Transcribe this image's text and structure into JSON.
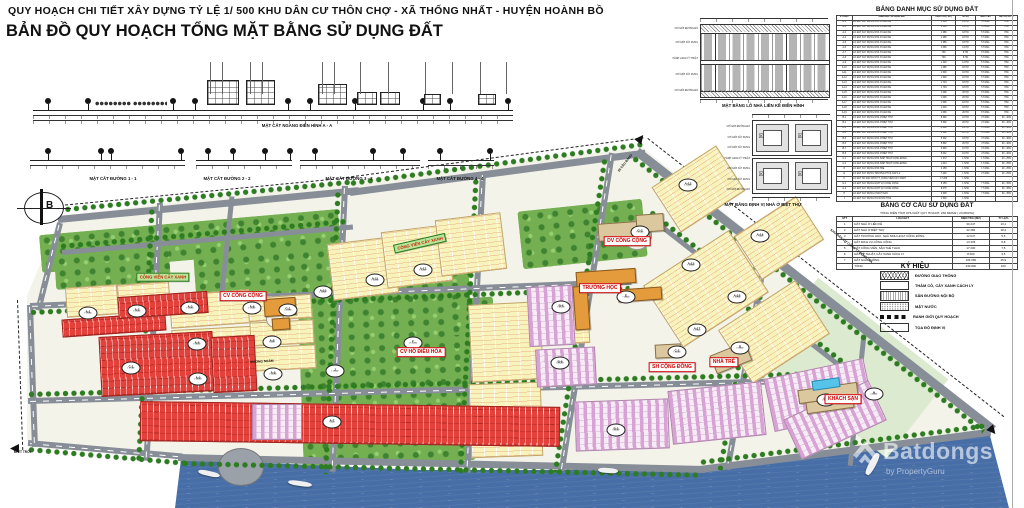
{
  "header": {
    "line1": "QUY HOẠCH CHI TIẾT XÂY DỰNG TỶ LỆ 1/ 500 KHU DÂN CƯ THÔN CHỢ - XÃ THỐNG NHẤT - HUYỆN HOÀNH BỒ",
    "line2": "BẢN ĐỒ QUY HOẠCH TỔNG MẶT BẰNG SỬ DỤNG ĐẤT"
  },
  "sections": {
    "aa": "MẶT CẮT NGANG ĐIỂN HÌNH A - A",
    "s1": "MẶT CẮT ĐƯỜNG 1 - 1",
    "s2": "MẶT CẮT ĐƯỜNG 2 - 2",
    "s3": "MẶT CẮT ĐƯỜNG 3 - 3",
    "s4": "MẶT CẮT ĐƯỜNG 4 - 4"
  },
  "diagrams": {
    "d1_caption": "MẶT BẰNG LÔ NHÀ LIỀN KỀ ĐIỂN HÌNH",
    "d2_caption": "MẶT BẰNG ĐỊNH VỊ NHÀ Ở BIỆT THỰ",
    "d1_side_labels": [
      "CHỈ GIỚI ĐƯỜNG ĐỎ",
      "CHỈ GIỚI XÂY DỰNG",
      "HÀNH LANG KỸ THUẬT",
      "CHỈ GIỚI XÂY DỰNG",
      "CHỈ GIỚI ĐƯỜNG ĐỎ"
    ],
    "d2_side_labels": [
      "CHỈ GIỚI ĐƯỜNG ĐỎ",
      "CHỈ GIỚI XÂY DỰNG",
      "CHỈ GIỚI XÂY DỰNG",
      "HÀNH LANG KỸ THUẬT",
      "CHỈ GIỚI XÂY DỰNG",
      "CHỈ GIỚI XÂY DỰNG",
      "CHỈ GIỚI ĐƯỜNG ĐỎ"
    ]
  },
  "land_use_table": {
    "title": "BẢNG DANH MỤC SỬ DỤNG ĐẤT",
    "headers": [
      "KÝ HIỆU",
      "DANH MỤC SỬ DỤNG ĐẤT",
      "DIỆN TÍCH ( M2 )",
      "SỐ HỘ",
      "TẦNG CAO",
      "MẬT ĐỘ XD %"
    ],
    "rows": [
      [
        "A-1",
        "LÔ ĐẤT XÂY DỰNG NHÀ Ở LIỀN KỀ",
        "1 096",
        "14 HỘ",
        "5 TẦNG",
        "70%"
      ],
      [
        "A-2",
        "LÔ ĐẤT XÂY DỰNG NHÀ Ở LIỀN KỀ",
        "1 096",
        "14 HỘ",
        "5 TẦNG",
        "70%"
      ],
      [
        "A-3",
        "LÔ ĐẤT XÂY DỰNG NHÀ Ở LIỀN KỀ",
        "1 386",
        "18 HỘ",
        "5 TẦNG",
        "70%"
      ],
      [
        "A-4",
        "LÔ ĐẤT XÂY DỰNG NHÀ Ở LIỀN KỀ",
        "1 386",
        "18 HỘ",
        "5 TẦNG",
        "70%"
      ],
      [
        "A-5",
        "LÔ ĐẤT XÂY DỰNG NHÀ Ở LIỀN KỀ",
        "1 386",
        "18 HỘ",
        "5 TẦNG",
        "70%"
      ],
      [
        "A-6",
        "LÔ ĐẤT XÂY DỰNG NHÀ Ở LIỀN KỀ",
        "1 096",
        "14 HỘ",
        "5 TẦNG",
        "70%"
      ],
      [
        "A-7",
        "LÔ ĐẤT XÂY DỰNG NHÀ Ở LIỀN KỀ",
        "790",
        "8 HỘ",
        "5 TẦNG",
        "70%"
      ],
      [
        "A-8",
        "LÔ ĐẤT XÂY DỰNG NHÀ Ở LIỀN KỀ",
        "790",
        "8 HỘ",
        "5 TẦNG",
        "70%"
      ],
      [
        "A-9",
        "LÔ ĐẤT XÂY DỰNG NHÀ Ở LIỀN KỀ",
        "1 400",
        "14 HỘ",
        "5 TẦNG",
        "70%"
      ],
      [
        "A-10",
        "LÔ ĐẤT XÂY DỰNG NHÀ Ở LIỀN KỀ",
        "1 386",
        "18 HỘ",
        "5 TẦNG",
        "70%"
      ],
      [
        "A-11",
        "LÔ ĐẤT XÂY DỰNG NHÀ Ở LIỀN KỀ",
        "1 600",
        "16 HỘ",
        "5 TẦNG",
        "70%"
      ],
      [
        "A-12",
        "LÔ ĐẤT XÂY DỰNG NHÀ Ở LIỀN KỀ",
        "1 600",
        "16 HỘ",
        "5 TẦNG",
        "70%"
      ],
      [
        "A-13",
        "LÔ ĐẤT XÂY DỰNG NHÀ Ở LIỀN KỀ",
        "1 704",
        "18 HỘ",
        "5 TẦNG",
        "70%"
      ],
      [
        "A-14",
        "LÔ ĐẤT XÂY DỰNG NHÀ Ở LIỀN KỀ",
        "1 704",
        "18 HỘ",
        "5 TẦNG",
        "70%"
      ],
      [
        "A-15",
        "LÔ ĐẤT XÂY DỰNG NHÀ Ở LIỀN KỀ",
        "1 096",
        "20 HỘ",
        "5 TẦNG",
        "70%"
      ],
      [
        "A-16",
        "LÔ ĐẤT XÂY DỰNG NHÀ Ở LIỀN KỀ",
        "1 096",
        "20 HỘ",
        "5 TẦNG",
        "70%"
      ],
      [
        "A-17",
        "LÔ ĐẤT XÂY DỰNG NHÀ Ở LIỀN KỀ",
        "1 096",
        "18 HỘ",
        "5 TẦNG",
        "70%"
      ],
      [
        "A-18",
        "LÔ ĐẤT XÂY DỰNG NHÀ Ở LIỀN KỀ",
        "1 003",
        "18 HỘ",
        "5 TẦNG",
        "70%"
      ],
      [
        "A-19",
        "LÔ ĐẤT XÂY DỰNG NHÀ Ở LIỀN KỀ",
        "1 096",
        "20 HỘ",
        "5 TẦNG",
        "70%"
      ],
      [
        "B-1",
        "LÔ ĐẤT XÂY DỰNG NHÀ Ở BIỆT THỰ",
        "5 692",
        "16 HỘ",
        "3 TẦNG",
        "30 - 40%"
      ],
      [
        "B-2",
        "LÔ ĐẤT XÂY DỰNG NHÀ Ở BIỆT THỰ",
        "5 692",
        "20 HỘ",
        "3 TẦNG",
        "30 - 40%"
      ],
      [
        "B-3",
        "LÔ ĐẤT XÂY DỰNG NHÀ Ở BIỆT THỰ",
        "6 288",
        "24 HỘ",
        "3 TẦNG",
        "30 - 40%"
      ],
      [
        "B-4",
        "LÔ ĐẤT XÂY DỰNG NHÀ Ở BIỆT THỰ",
        "5 692",
        "20 HỘ",
        "3 TẦNG",
        "30 - 40%"
      ],
      [
        "B-5",
        "LÔ ĐẤT XÂY DỰNG NHÀ Ở BIỆT THỰ",
        "5 302",
        "18 HỘ",
        "3 TẦNG",
        "30 - 40%"
      ],
      [
        "B-6",
        "LÔ ĐẤT XÂY DỰNG NHÀ Ở BIỆT THỰ",
        "5 892",
        "20 HỘ",
        "3 TẦNG",
        "30 - 40%"
      ],
      [
        "B-7",
        "LÔ ĐẤT XÂY DỰNG NHÀ Ở BIỆT THỰ",
        "3 690",
        "10 HỘ",
        "3 TẦNG",
        "30 - 40%"
      ],
      [
        "B-8",
        "LÔ ĐẤT XÂY DỰNG NHÀ Ở BIỆT THỰ",
        "5 042",
        "16 HỘ",
        "3 TẦNG",
        "30 - 40%"
      ],
      [
        "C-1",
        "LÔ ĐẤT XÂY DỰNG NHÀ SINH HOẠT CỘNG ĐỒNG",
        "1 372",
        "1 NHÀ",
        "1 TẦNG",
        "20 - 25%"
      ],
      [
        "C-2",
        "LÔ ĐẤT XÂY DỰNG NHÀ SINH HOẠT CỘNG ĐỒNG",
        "1 044",
        "1 NHÀ",
        "1 TẦNG",
        "20 - 25%"
      ],
      [
        "D",
        "LÔ ĐẤT XÂY DỰNG NHÀ TRẺ",
        "2 158",
        "1 NHÀ",
        "1 TẦNG",
        "20 - 25%"
      ],
      [
        "E",
        "LÔ ĐẤT XÂY DỰNG TRƯỜNG PTCS CẤP 1,2",
        "7 200",
        "1 NHÀ",
        "2 TẦNG",
        "20 - 25%"
      ],
      [
        "F",
        "LÔ ĐẤT XD SÂN CHƠI TT, CÔNG VIÊN CÂY XANH",
        "17 200",
        "1 NHÀ",
        "",
        ""
      ],
      [
        "G-1",
        "LÔ ĐẤT XÂY DỰNG DỊCH VỤ CÔNG CỘNG",
        "5 158",
        "1 NHÀ",
        "7 TẦNG",
        "30 - 35%"
      ],
      [
        "G-2",
        "LÔ ĐẤT XÂY DỰNG DỊCH VỤ CÔNG CỘNG",
        "8 075",
        "1 NHÀ",
        "7 TẦNG",
        "30 - 35%"
      ],
      [
        "H",
        "LÔ ĐẤT XÂY DỰNG KHÁCH SẠN",
        "4 608",
        "1 NHÀ",
        "7 TẦNG",
        "30 - 35%"
      ],
      [
        "J",
        "LÔ ĐẤT XÂY DỰNG HỒ NƯỚC THẢI",
        "1 500",
        "1 NHÀ",
        "",
        ""
      ]
    ]
  },
  "structure_table": {
    "title": "BẢNG CƠ CẤU SỬ DỤNG ĐẤT",
    "subtitle": "TỔNG DIỆN TÍCH KHU ĐẤT QUY HOẠCH: 230 840M2 ( 23,084HA)",
    "headers": [
      "STT",
      "LOẠI ĐẤT",
      "DIỆN TÍCH (M2)",
      "TỶ LỆ%"
    ],
    "rows": [
      [
        "1",
        "ĐẤT NHÀ Ở LIỀN KỀ",
        "30 247",
        "13,1"
      ],
      [
        "2",
        "ĐẤT NHÀ Ở BIỆT THỰ",
        "42 282",
        "18,4"
      ],
      [
        "3",
        "ĐẤT TRƯỜNG HỌC, NHÀ SINH HOẠT CỘNG ĐỒNG",
        "12 647",
        "5,5"
      ],
      [
        "4",
        "ĐẤT DỊCH VỤ CÔNG CỘNG",
        "13 333",
        "5,8"
      ],
      [
        "5",
        "ĐẤT CÔNG VIÊN, SÂN THỂ THAO",
        "17 200",
        "7,5"
      ],
      [
        "6",
        "ĐẤT KỸ THUẬT, CÂY XANH CÁCH LY",
        "8 000",
        "3,5"
      ],
      [
        "7",
        "ĐẤT GIAO THÔNG",
        "106 065",
        "45,9"
      ],
      [
        "",
        "TỔNG",
        "230 840",
        "100"
      ]
    ]
  },
  "legend": {
    "title": "KÝ HIỆU",
    "items": [
      "ĐƯỜNG GIAO THÔNG",
      "THẢM CỎ, CÂY XANH CÁCH LY",
      "SÂN ĐƯỜNG NỘI BỘ",
      "MẶT NƯỚC",
      "RANH GIỚI QUY HOẠCH",
      "TỌA ĐỘ ĐỊNH VỊ"
    ]
  },
  "map": {
    "compass": "B",
    "area_badges": [
      {
        "label": "A-1",
        "sub": "1 096M2",
        "x": 88,
        "y": 313
      },
      {
        "label": "A-2",
        "sub": "1 096M2",
        "x": 137,
        "y": 311
      },
      {
        "label": "A-3",
        "sub": "1 386M2",
        "x": 190,
        "y": 308
      },
      {
        "label": "A-4",
        "sub": "1 386M2",
        "x": 197,
        "y": 344
      },
      {
        "label": "A-5",
        "sub": "1 386M2",
        "x": 198,
        "y": 379
      },
      {
        "label": "A-6",
        "sub": "1 096M2",
        "x": 252,
        "y": 308
      },
      {
        "label": "A-7",
        "sub": "790M2",
        "x": 332,
        "y": 422
      },
      {
        "label": "A-8",
        "sub": "790M2",
        "x": 272,
        "y": 342
      },
      {
        "label": "A-9",
        "sub": "1 400M2",
        "x": 273,
        "y": 374
      },
      {
        "label": "A-10",
        "sub": "1 386M2",
        "x": 323,
        "y": 292
      },
      {
        "label": "A-11",
        "sub": "1 600M2",
        "x": 375,
        "y": 280
      },
      {
        "label": "A-12",
        "sub": "1 600M2",
        "x": 423,
        "y": 270
      },
      {
        "label": "A-13",
        "sub": "1 704M2",
        "x": 688,
        "y": 185
      },
      {
        "label": "A-14",
        "sub": "1 704M2",
        "x": 760,
        "y": 236
      },
      {
        "label": "A-15",
        "sub": "1 096M2",
        "x": 691,
        "y": 265
      },
      {
        "label": "A-16",
        "sub": "1 096M2",
        "x": 737,
        "y": 297
      },
      {
        "label": "A-17",
        "sub": "1 096M2",
        "x": 697,
        "y": 330
      },
      {
        "label": "B-4",
        "sub": "5 692M2",
        "x": 561,
        "y": 307
      },
      {
        "label": "B-5",
        "sub": "5 302M2",
        "x": 616,
        "y": 430
      },
      {
        "label": "B-6",
        "sub": "5 892M2",
        "x": 560,
        "y": 363
      },
      {
        "label": "B-8",
        "sub": "5 042M2",
        "x": 826,
        "y": 400
      },
      {
        "label": "C-1",
        "sub": "1 372M2",
        "x": 131,
        "y": 368
      },
      {
        "label": "C-2",
        "sub": "1 044M2",
        "x": 677,
        "y": 352
      },
      {
        "label": "D",
        "sub": "2 158M2",
        "x": 740,
        "y": 348
      },
      {
        "label": "E",
        "sub": "7 200M2",
        "x": 626,
        "y": 297
      },
      {
        "label": "F",
        "sub": "17 200M2",
        "x": 413,
        "y": 343
      },
      {
        "label": "G-1",
        "sub": "5 158M2",
        "x": 288,
        "y": 310
      },
      {
        "label": "G-2",
        "sub": "8 075M2",
        "x": 640,
        "y": 232
      },
      {
        "label": "H",
        "sub": "4 608M2",
        "x": 874,
        "y": 394
      },
      {
        "label": "J",
        "sub": "1 500M2",
        "x": 335,
        "y": 371
      }
    ],
    "site_labels": [
      {
        "text": "CV CÔNG CỘNG",
        "x": 243,
        "y": 296,
        "style": "red",
        "rot": 0
      },
      {
        "text": "DV CÔNG CỘNG",
        "x": 627,
        "y": 241,
        "style": "red",
        "rot": 0
      },
      {
        "text": "TRƯỜNG HỌC",
        "x": 600,
        "y": 288,
        "style": "red",
        "rot": 0
      },
      {
        "text": "CV HỒ ĐIỀU HÒA",
        "x": 421,
        "y": 352,
        "style": "red",
        "rot": 0
      },
      {
        "text": "SH CỘNG ĐỒNG",
        "x": 672,
        "y": 367,
        "style": "red",
        "rot": 0
      },
      {
        "text": "NHÀ TRẺ",
        "x": 724,
        "y": 362,
        "style": "red",
        "rot": 0
      },
      {
        "text": "KHÁCH SẠN",
        "x": 843,
        "y": 399,
        "style": "red",
        "rot": 0
      },
      {
        "text": "CÔNG VIÊN CÂY XANH",
        "x": 163,
        "y": 277,
        "style": "green",
        "rot": 0
      },
      {
        "text": "CÔNG VIÊN CÂY XANH",
        "x": 420,
        "y": 243,
        "style": "green",
        "rot": -13
      }
    ],
    "road_labels": [
      {
        "text": "ĐI CẦU BANG",
        "x": 617,
        "y": 170,
        "rot": -52
      },
      {
        "text": "KHU DÂN CƯ CÔNG TY ĐÔNG GIA",
        "x": 832,
        "y": 228,
        "rot": 38.5
      },
      {
        "text": "ĐI TT TRỚI",
        "x": 14,
        "y": 450,
        "rot": 0
      },
      {
        "text": "MƯƠNG NGẦM",
        "x": 250,
        "y": 360,
        "rot": -3
      }
    ]
  },
  "watermark": {
    "brand": "Batdongs",
    "byline": "by PropertyGuru"
  }
}
